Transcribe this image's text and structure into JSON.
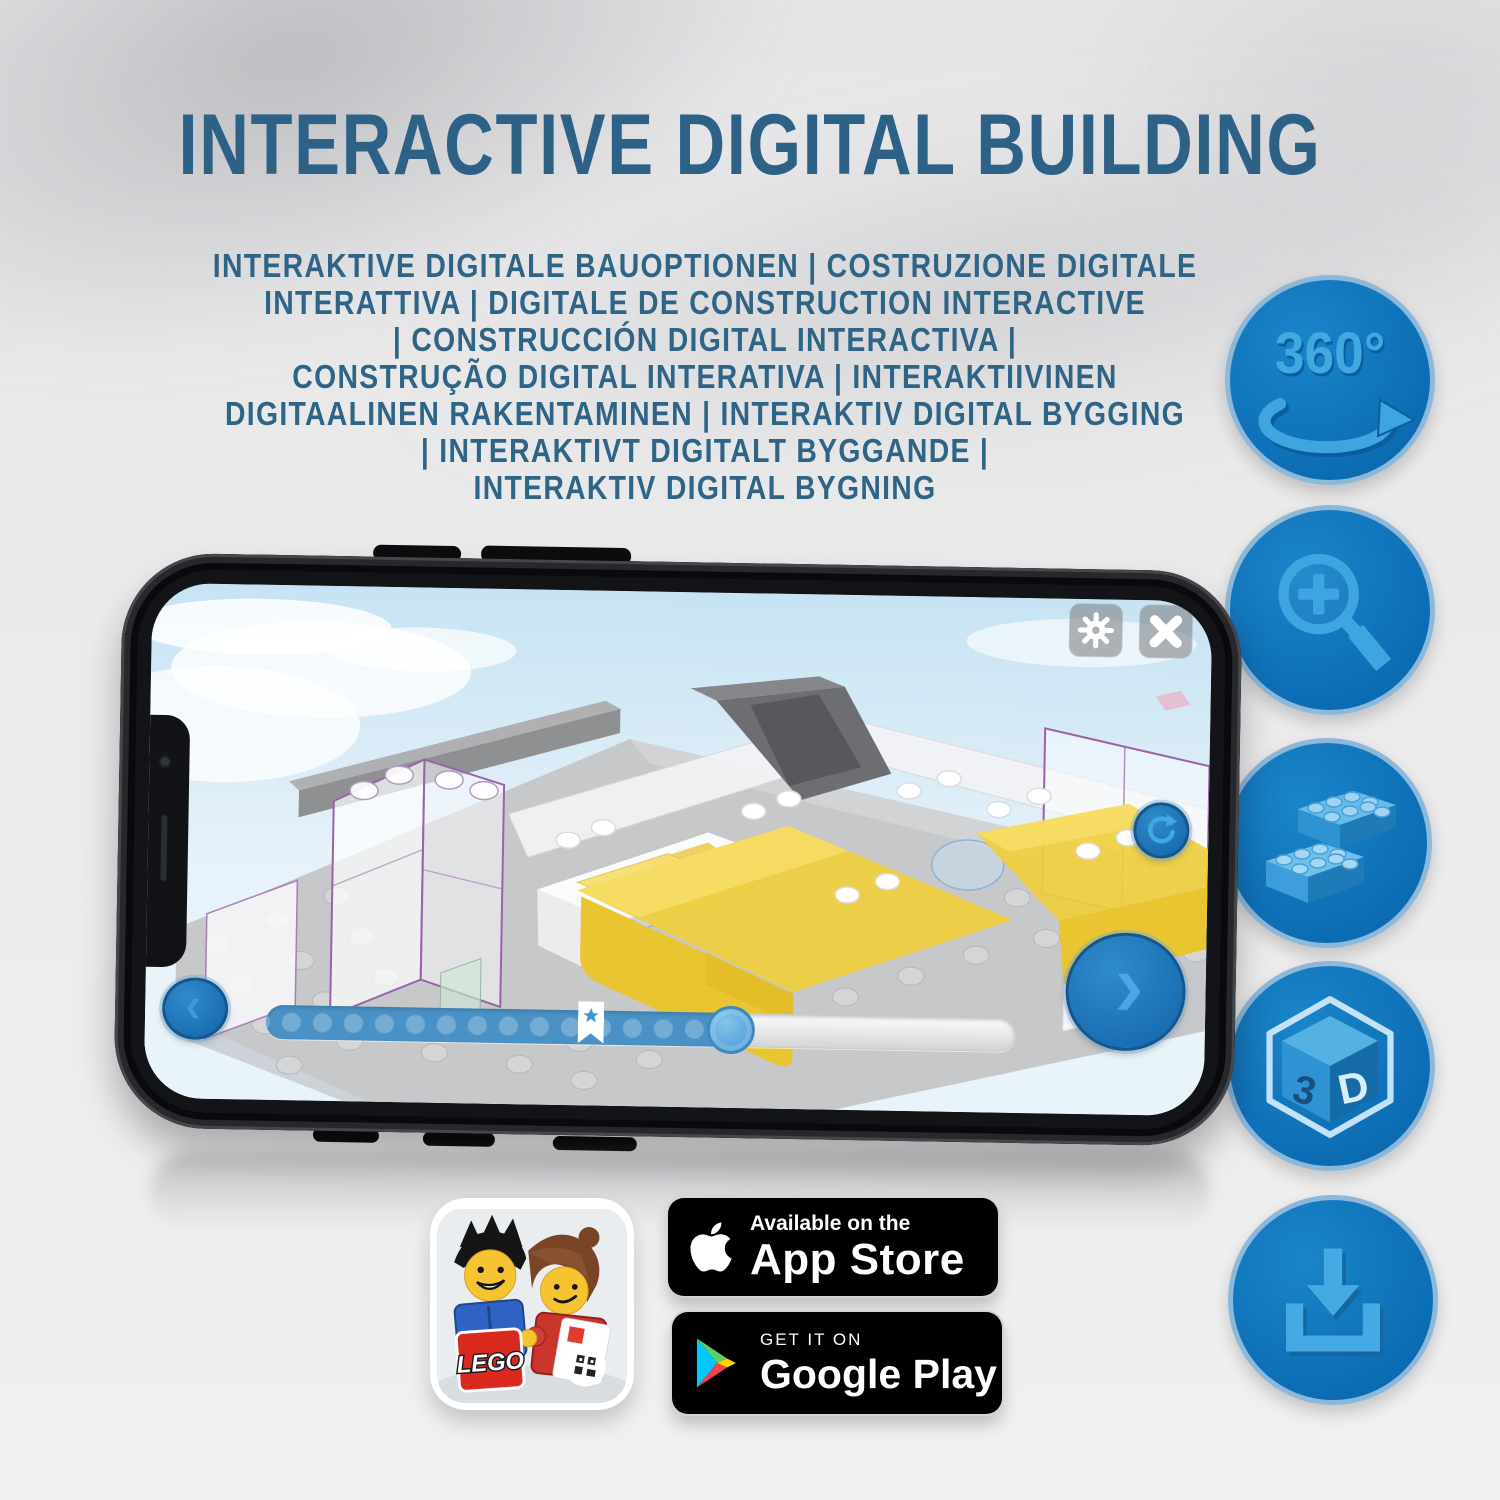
{
  "poster": {
    "title": "INTERACTIVE DIGITAL BUILDING",
    "subtitle_lines": [
      "INTERAKTIVE DIGITALE BAUOPTIONEN | COSTRUZIONE DIGITALE",
      "INTERATTIVA | DIGITALE DE CONSTRUCTION INTERACTIVE",
      "| CONSTRUCCIÓN DIGITAL INTERACTIVA |",
      "CONSTRUÇÃO DIGITAL INTERATIVA | INTERAKTIIVINEN",
      "DIGITAALINEN RAKENTAMINEN | INTERAKTIV DIGITAL BYGGING",
      "| INTERAKTIVT DIGITALT BYGGANDE |",
      "INTERAKTIV DIGITAL BYGNING"
    ]
  },
  "feature_rail": {
    "items": [
      {
        "name": "360-rotation-icon",
        "label": "360°"
      },
      {
        "name": "zoom-in-icon"
      },
      {
        "name": "brick-stack-icon"
      },
      {
        "name": "3d-cube-icon",
        "face_left": "3",
        "face_right": "D"
      },
      {
        "name": "download-icon"
      }
    ]
  },
  "phone_app": {
    "toolbar_buttons": [
      "settings-gear",
      "close-x"
    ],
    "nav_buttons": [
      "previous-step",
      "rotate-model",
      "next-step"
    ],
    "progress": {
      "filled_percent": 62,
      "bookmark_percent": 43
    }
  },
  "badges": {
    "app_store": {
      "top_line": "Available on the",
      "bottom_line": "App Store"
    },
    "google_play": {
      "top_line": "GET IT ON",
      "bottom_line": "Google Play"
    },
    "lego_app": {
      "logo_text": "LEGO"
    }
  },
  "colors": {
    "heading_blue": "#2d6186",
    "circle_fill": "#0d6eb5",
    "circle_glyph": "#3fa5e0",
    "progress_fill": "#4a92c6",
    "screen_button_blue": "#1a6fb2",
    "brick_yellow": "#f0ce3e"
  }
}
